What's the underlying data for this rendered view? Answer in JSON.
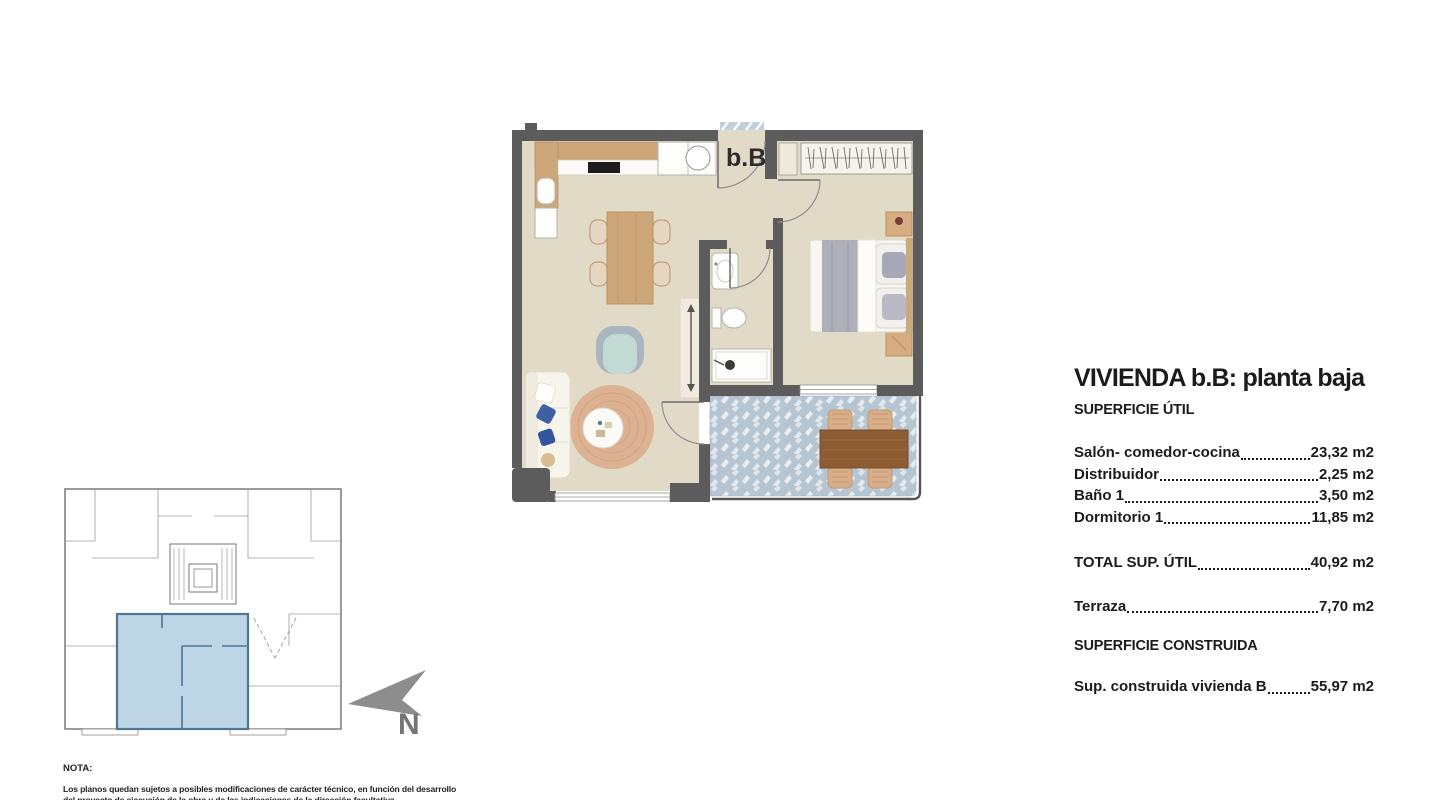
{
  "plan": {
    "unit_label": "b.B"
  },
  "north_indicator": {
    "label": "N"
  },
  "summary": {
    "title": "VIVIENDA b.B: planta baja",
    "useful_area_heading": "SUPERFICIE ÚTIL",
    "rows": [
      {
        "label": "Salón- comedor-cocina",
        "value": "23,32 m2"
      },
      {
        "label": "Distribuidor",
        "value": "2,25 m2"
      },
      {
        "label": "Baño 1",
        "value": "3,50 m2"
      },
      {
        "label": "Dormitorio 1",
        "value": "11,85 m2"
      }
    ],
    "total_row": {
      "label": "TOTAL SUP. ÚTIL",
      "value": "40,92 m2"
    },
    "terrace_row": {
      "label": "Terraza",
      "value": "7,70 m2"
    },
    "built_area_heading": "SUPERFICIE CONSTRUIDA",
    "built_row": {
      "label": "Sup. construida vivienda B",
      "value": "55,97 m2"
    }
  },
  "note": {
    "heading": "NOTA:",
    "line1": "Los planos quedan sujetos a posibles modificaciones de carácter técnico, en función del desarrollo",
    "line2": "del proyecto de ejecución de la obra y de las indicaciones de la dirección facultativa."
  },
  "colors": {
    "wall": "#5c5c5c",
    "floor": "#e0dac6",
    "tile": "#b6c5d2",
    "tilelight": "#e9eef2",
    "wood": "#cda77a",
    "wooddark": "#8e5c33",
    "highlight": "#bdd5e5",
    "highlightwall": "#4e7694",
    "text": "#1b1b1b",
    "arrow": "#8d8d8d"
  }
}
